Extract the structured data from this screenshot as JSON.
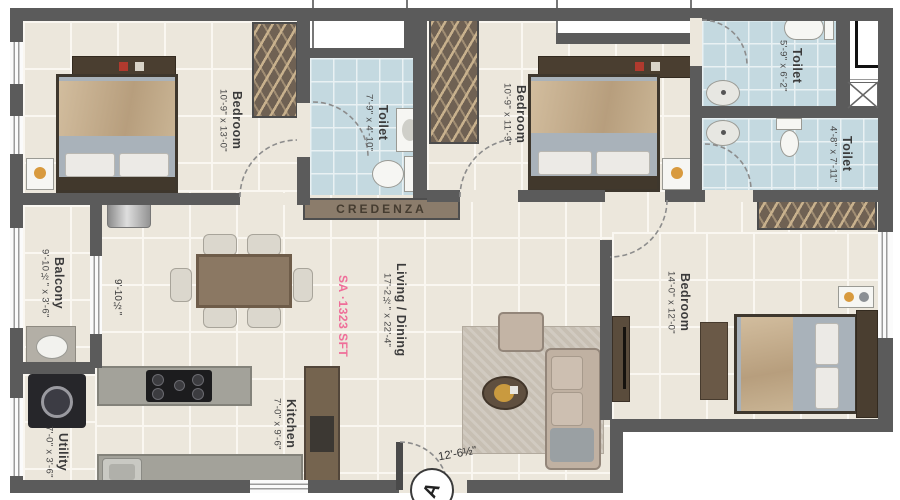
{
  "plan": {
    "rooms": {
      "bedroom1": {
        "name": "Bedroom",
        "dims": "10'-9\" x 13'-0\""
      },
      "toilet1": {
        "name": "Toilet",
        "dims": "7'-9\" x 4'-10\""
      },
      "bedroom2": {
        "name": "Bedroom",
        "dims": "10'-9\" x 11'-9\""
      },
      "toilet2": {
        "name": "Toilet",
        "dims": "5'-9\" x 6'-2\""
      },
      "toilet3": {
        "name": "Toilet",
        "dims": "4'-8\" x 7'-11\""
      },
      "bedroom3": {
        "name": "Bedroom",
        "dims": "14'-0\" x 12'-0\""
      },
      "balcony": {
        "name": "Balcony",
        "dims": "9'-10½\" x 3'-6\""
      },
      "living": {
        "name": "Living / Dining",
        "dims": "17'-2½\" x 22'-4\"",
        "area": "SA ·1323 SFT"
      },
      "kitchen": {
        "name": "Kitchen",
        "dims": "7'-0\" x 9'-6\""
      },
      "utility": {
        "name": "Utility",
        "dims": "7'-0\" x 3'-6\""
      }
    },
    "labels": {
      "credenza": "CREDENZA",
      "entrance_marker": "A",
      "dim_living_width": "12'-6½\"",
      "dim_balcony_length": "9'-10½\""
    },
    "colors": {
      "wall": "#5b5b5b",
      "floor": "#ece7dc",
      "toilet_floor": "#c4d9e0",
      "wood": "#6f6153",
      "accent_text": "#ef6e99",
      "label_text": "#3b3b3b"
    }
  }
}
